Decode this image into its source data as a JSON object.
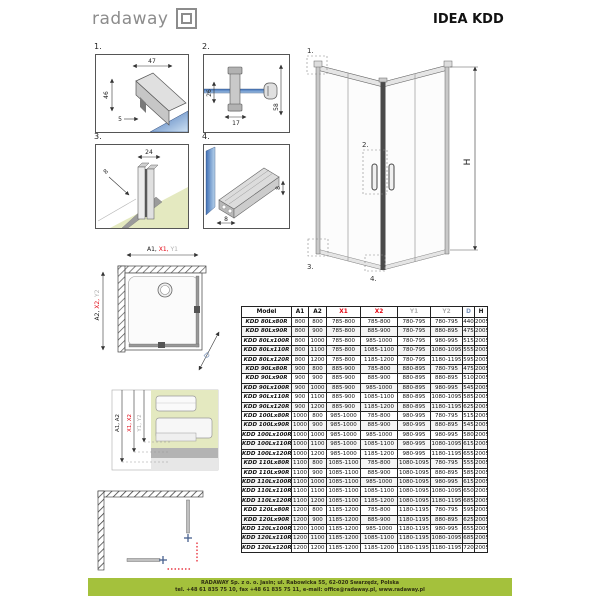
{
  "header": {
    "logo_text": "radaway",
    "title": "IDEA KDD"
  },
  "details": {
    "d1": {
      "label": "1.",
      "dim_width": "47",
      "dim_height": "46",
      "dim_seal": "5"
    },
    "d2": {
      "label": "2.",
      "dim_left": "26",
      "dim_bottom": "17",
      "dim_right": "58"
    },
    "d3": {
      "label": "3.",
      "dim_top": "24",
      "dim_diag": "8"
    },
    "d4": {
      "label": "4.",
      "dim_bottom": "8",
      "dim_right": "8"
    }
  },
  "perspective": {
    "c1": "1.",
    "c2": "2.",
    "c3": "3.",
    "c4": "4.",
    "height": "H"
  },
  "topview": {
    "top_label_parts": [
      {
        "text": "A1, ",
        "color": "#1a1a1a"
      },
      {
        "text": "X1, ",
        "color": "#e30613"
      },
      {
        "text": "Y1",
        "color": "#b0b0b0"
      }
    ],
    "left_label_parts": [
      {
        "text": "A2, ",
        "color": "#1a1a1a"
      },
      {
        "text": "X2, ",
        "color": "#e30613"
      },
      {
        "text": "Y2",
        "color": "#b0b0b0"
      }
    ],
    "diag": "D"
  },
  "section": {
    "dim_a": "A1, A2",
    "dim_x": "X1, X2",
    "dim_y": "Y1, Y2"
  },
  "table": {
    "columns": [
      {
        "label": "Model",
        "color": "#111111"
      },
      {
        "label": "A1",
        "color": "#111111"
      },
      {
        "label": "A2",
        "color": "#111111"
      },
      {
        "label": "X1",
        "color": "#e30613"
      },
      {
        "label": "X2",
        "color": "#e30613"
      },
      {
        "label": "Y1",
        "color": "#b0b0b0"
      },
      {
        "label": "Y2",
        "color": "#b0b0b0"
      },
      {
        "label": "D",
        "color": "#7b95bd"
      },
      {
        "label": "H",
        "color": "#111111"
      }
    ],
    "rows": [
      [
        "KDD 80Lx80R",
        "800",
        "800",
        "785-800",
        "785-800",
        "780-795",
        "780-795",
        "440",
        "2005"
      ],
      [
        "KDD 80Lx90R",
        "800",
        "900",
        "785-800",
        "885-900",
        "780-795",
        "880-895",
        "475",
        "2005"
      ],
      [
        "KDD 80Lx100R",
        "800",
        "1000",
        "785-800",
        "985-1000",
        "780-795",
        "980-995",
        "515",
        "2005"
      ],
      [
        "KDD 80Lx110R",
        "800",
        "1100",
        "785-800",
        "1085-1100",
        "780-795",
        "1080-1095",
        "555",
        "2005"
      ],
      [
        "KDD 80Lx120R",
        "800",
        "1200",
        "785-800",
        "1185-1200",
        "780-795",
        "1180-1195",
        "595",
        "2005"
      ],
      [
        "KDD 90Lx80R",
        "900",
        "800",
        "885-900",
        "785-800",
        "880-895",
        "780-795",
        "475",
        "2005"
      ],
      [
        "KDD 90Lx90R",
        "900",
        "900",
        "885-900",
        "885-900",
        "880-895",
        "880-895",
        "510",
        "2005"
      ],
      [
        "KDD 90Lx100R",
        "900",
        "1000",
        "885-900",
        "985-1000",
        "880-895",
        "980-995",
        "545",
        "2005"
      ],
      [
        "KDD 90Lx110R",
        "900",
        "1100",
        "885-900",
        "1085-1100",
        "880-895",
        "1080-1095",
        "585",
        "2005"
      ],
      [
        "KDD 90Lx120R",
        "900",
        "1200",
        "885-900",
        "1185-1200",
        "880-895",
        "1180-1195",
        "625",
        "2005"
      ],
      [
        "KDD 100Lx80R",
        "1000",
        "800",
        "985-1000",
        "785-800",
        "980-995",
        "780-795",
        "515",
        "2005"
      ],
      [
        "KDD 100Lx90R",
        "1000",
        "900",
        "985-1000",
        "885-900",
        "980-995",
        "880-895",
        "545",
        "2005"
      ],
      [
        "KDD 100Lx100R",
        "1000",
        "1000",
        "985-1000",
        "985-1000",
        "980-995",
        "980-995",
        "580",
        "2005"
      ],
      [
        "KDD 100Lx110R",
        "1000",
        "1100",
        "985-1000",
        "1085-1100",
        "980-995",
        "1080-1095",
        "615",
        "2005"
      ],
      [
        "KDD 100Lx120R",
        "1000",
        "1200",
        "985-1000",
        "1185-1200",
        "980-995",
        "1180-1195",
        "655",
        "2005"
      ],
      [
        "KDD 110Lx80R",
        "1100",
        "800",
        "1085-1100",
        "785-800",
        "1080-1095",
        "780-795",
        "555",
        "2005"
      ],
      [
        "KDD 110Lx90R",
        "1100",
        "900",
        "1085-1100",
        "885-900",
        "1080-1095",
        "880-895",
        "585",
        "2005"
      ],
      [
        "KDD 110Lx100R",
        "1100",
        "1000",
        "1085-1100",
        "985-1000",
        "1080-1095",
        "980-995",
        "615",
        "2005"
      ],
      [
        "KDD 110Lx110R",
        "1100",
        "1100",
        "1085-1100",
        "1085-1100",
        "1080-1095",
        "1080-1095",
        "650",
        "2005"
      ],
      [
        "KDD 110Lx120R",
        "1100",
        "1200",
        "1085-1100",
        "1185-1200",
        "1080-1095",
        "1180-1195",
        "685",
        "2005"
      ],
      [
        "KDD 120Lx80R",
        "1200",
        "800",
        "1185-1200",
        "785-800",
        "1180-1195",
        "780-795",
        "595",
        "2005"
      ],
      [
        "KDD 120Lx90R",
        "1200",
        "900",
        "1185-1200",
        "885-900",
        "1180-1195",
        "880-895",
        "625",
        "2005"
      ],
      [
        "KDD 120Lx100R",
        "1200",
        "1000",
        "1185-1200",
        "985-1000",
        "1180-1195",
        "980-995",
        "655",
        "2005"
      ],
      [
        "KDD 120Lx110R",
        "1200",
        "1100",
        "1185-1200",
        "1085-1100",
        "1180-1195",
        "1080-1095",
        "685",
        "2005"
      ],
      [
        "KDD 120Lx120R",
        "1200",
        "1200",
        "1185-1200",
        "1185-1200",
        "1180-1195",
        "1180-1195",
        "720",
        "2005"
      ]
    ]
  },
  "footer": {
    "bg": "#a4c13c",
    "line1": "RADAWAY Sp. z o. o. Jasin; ul. Rabowicka 55, 62-020 Swarzędz, Polska",
    "line2": "tel. +48 61 835 75 10, fax +48 61 835 75 11, e-mail: office@radaway.pl, www.radaway.pl"
  },
  "colors": {
    "red": "#e30613",
    "gray": "#b0b0b0",
    "blue": "#7b95bd"
  }
}
